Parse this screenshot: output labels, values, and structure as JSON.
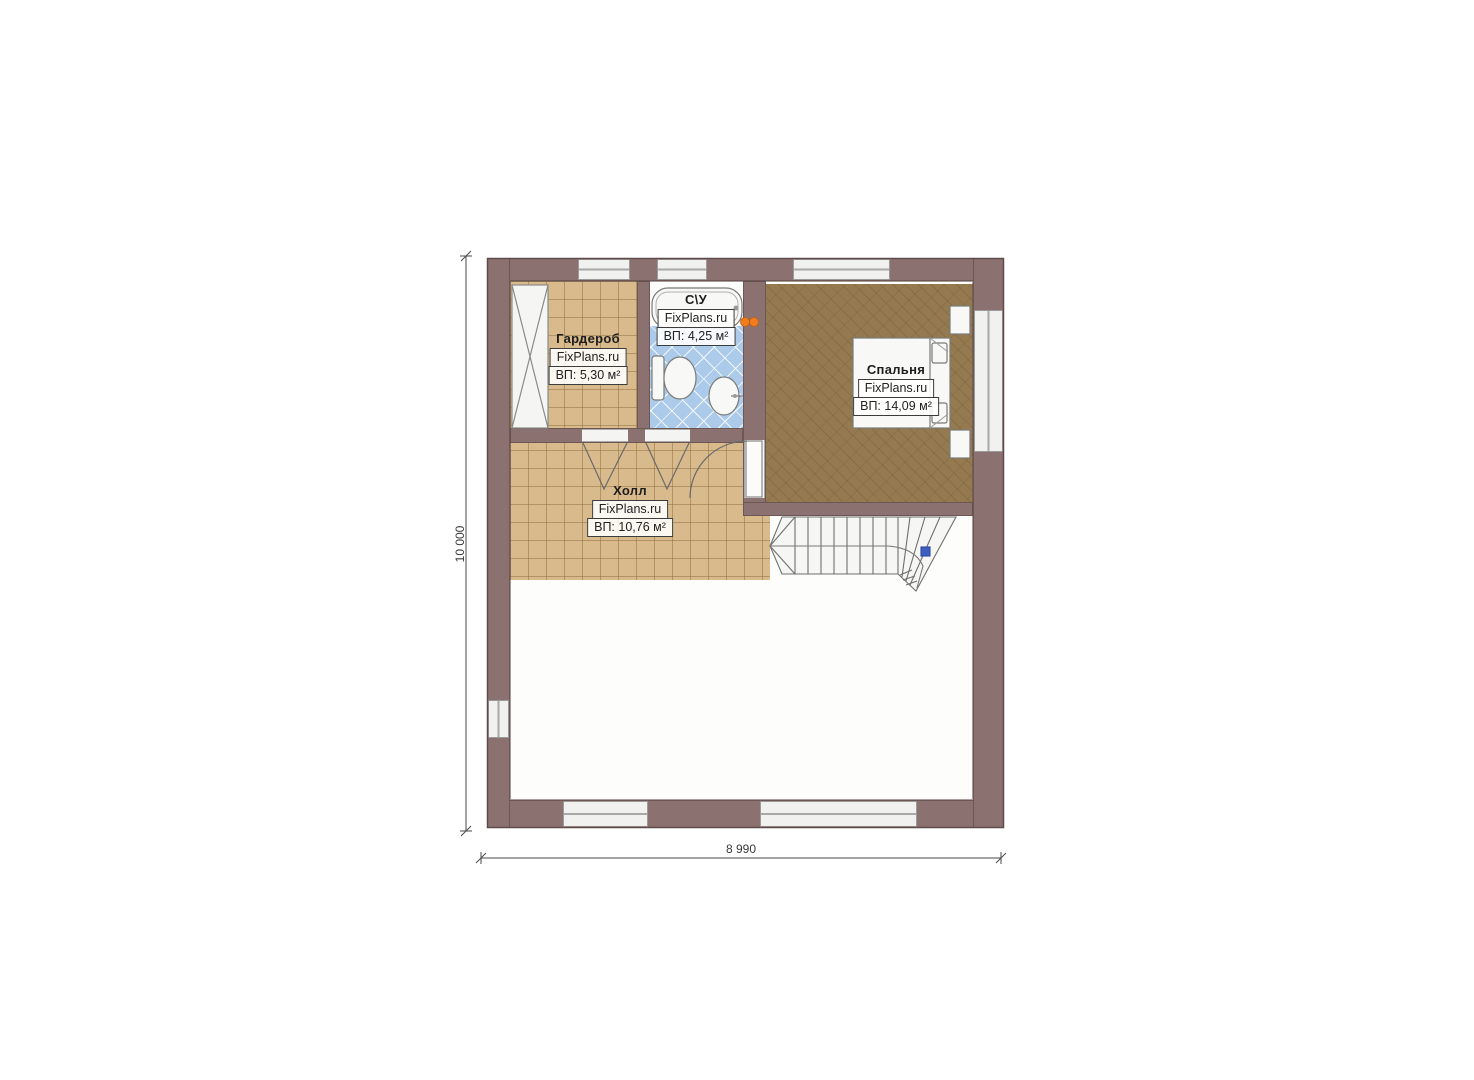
{
  "watermark": "FixPlans.ru",
  "rooms": {
    "wardrobe": {
      "name": "Гардероб",
      "area": "ВП: 5,30 м²"
    },
    "bathroom": {
      "name": "С\\У",
      "area": "ВП: 4,25 м²"
    },
    "bedroom": {
      "name": "Спальня",
      "area": "ВП: 14,09 м²"
    },
    "hall": {
      "name": "Холл",
      "area": "ВП: 10,76 м²"
    }
  },
  "dimensions": {
    "height": "10 000",
    "width": "8 990"
  },
  "colors": {
    "wall": "#8b7270",
    "tile_beige": "#d8ba8d",
    "tile_blue": "#accae9",
    "wood_floor": "#957a50",
    "sconce_orange": "#f07c1e",
    "stair_marker_blue": "#3f5fc0"
  }
}
